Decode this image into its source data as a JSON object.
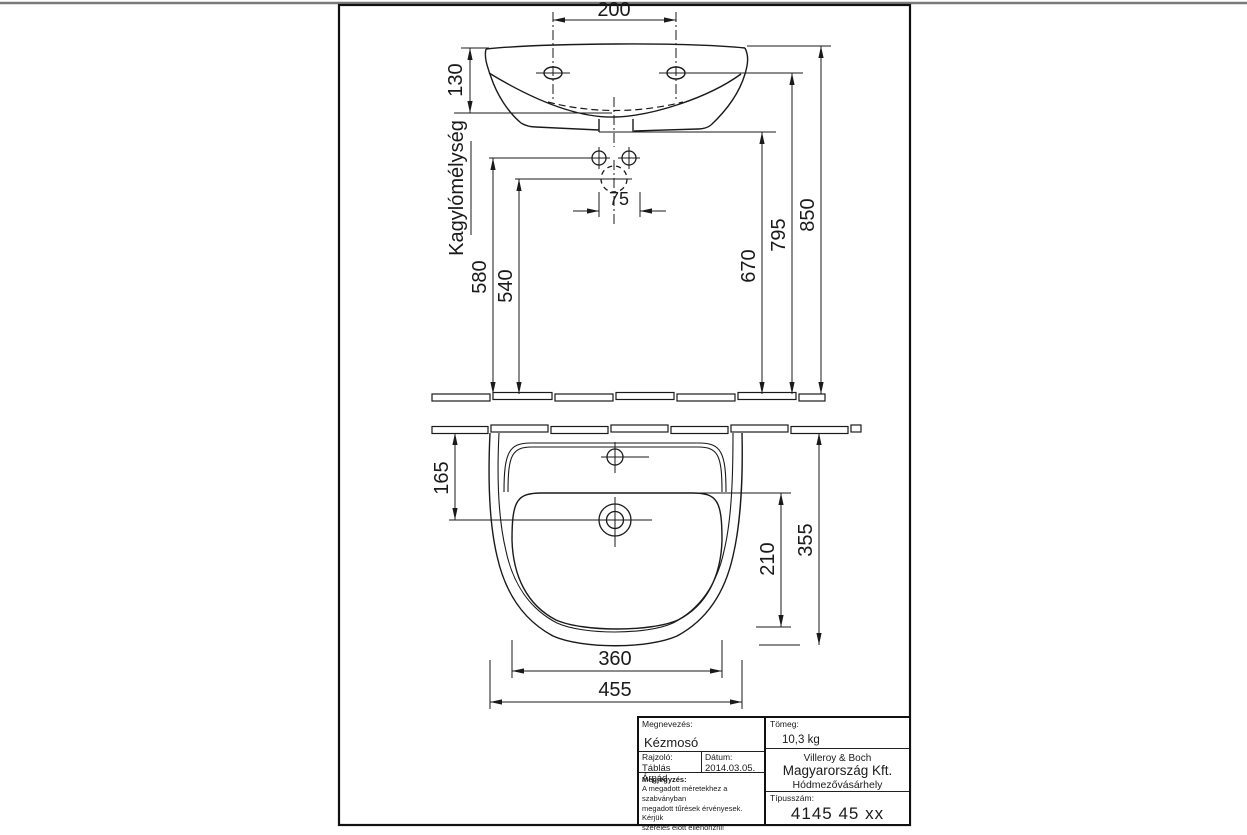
{
  "colors": {
    "line": "#1a1a1a",
    "frame": "#111111",
    "background": "#ffffff",
    "top_edge_line": "#7a7a7a"
  },
  "drawing": {
    "front_view": {
      "dim_hole_spacing": "200",
      "dim_rim_height": "130",
      "bowl_depth_label": "Kagylómélység",
      "dim_tap_holes": "75",
      "dim_540": "540",
      "dim_580": "580",
      "dim_670": "670",
      "dim_795": "795",
      "dim_850": "850"
    },
    "top_view": {
      "dim_drain_from_wall": "165",
      "dim_bowl_depth": "210",
      "dim_total_depth": "355",
      "dim_bowl_width": "360",
      "dim_total_width": "455"
    }
  },
  "title_block": {
    "megnevezes_label": "Megnevezés:",
    "megnevezes_value": "Kézmosó",
    "rajzolo_label": "Rajzoló:",
    "rajzolo_value": "Táblás Árpád",
    "datum_label": "Dátum:",
    "datum_value": "2014.03.05.",
    "megjegyzes_label": "Megjegyzés:",
    "megjegyzes_line1": "A megadott méretekhez a szabványban",
    "megjegyzes_line2": "megadott tűrések érvényesek. Kérjük",
    "megjegyzes_line3": "szerelés előtt ellenőrizni!",
    "tomeg_label": "Tömeg:",
    "tomeg_value": "10,3 kg",
    "company_line1": "Villeroy  & Boch",
    "company_line2": "Magyarország Kft.",
    "company_line3": "Hódmezővásárhely",
    "tipusszam_label": "Típusszám:",
    "tipusszam_value": "4145 45 xx"
  }
}
